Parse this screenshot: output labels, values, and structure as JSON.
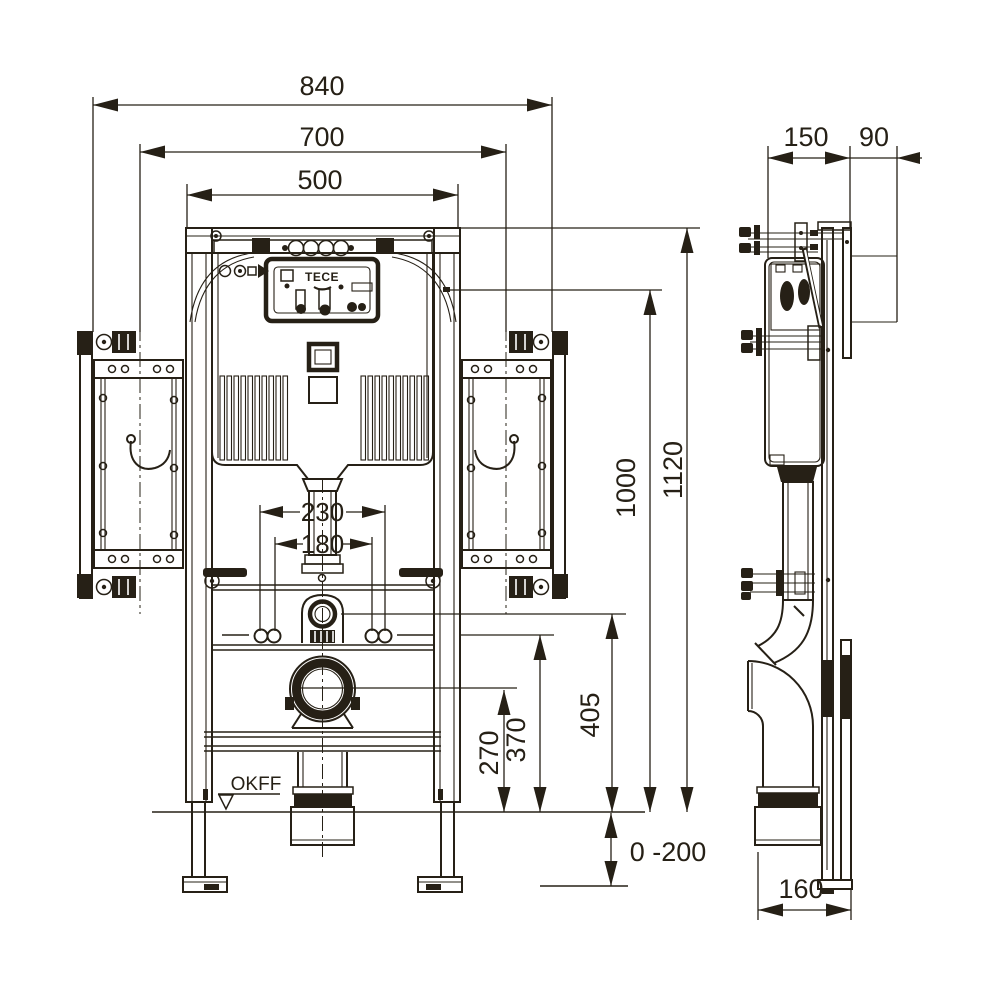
{
  "dimensions": {
    "top_width_outer": "840",
    "top_width_mount": "700",
    "top_width_frame": "500",
    "side_depth_frame": "150",
    "side_depth_wall": "90",
    "height_cistern": "1000",
    "height_frame": "1120",
    "bolt_spacing_outer": "230",
    "bolt_spacing_inner": "180",
    "height_drain_center": "270",
    "height_rail": "370",
    "height_flush_center": "405",
    "floor_adjustment": "0 -200",
    "side_depth_foot": "160"
  },
  "labels": {
    "floor_level": "OKFF",
    "brand": "TECE"
  }
}
